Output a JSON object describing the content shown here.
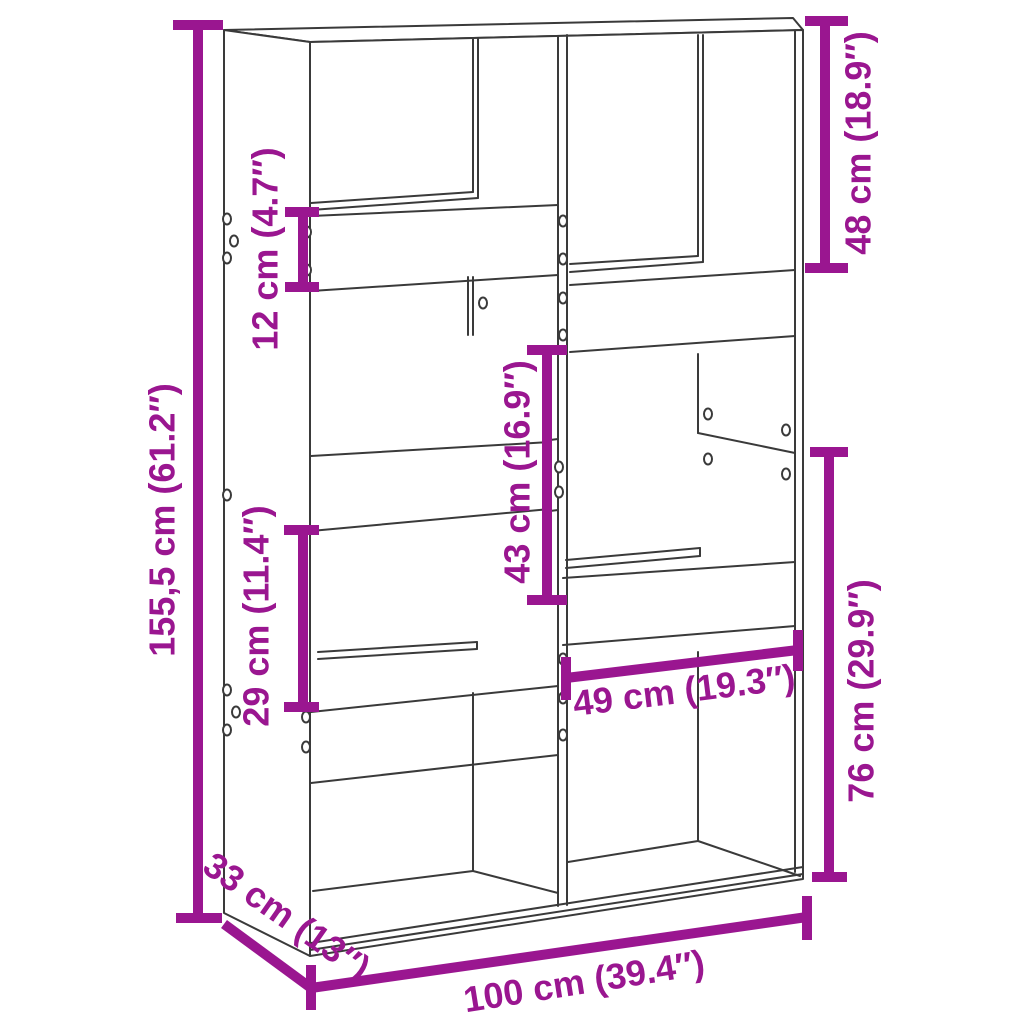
{
  "product_diagram": {
    "kind": "bookcase-room-divider-dimension-drawing",
    "colors": {
      "dimension_accent": "#9A1690",
      "drawing_line": "#3a3a3a",
      "background": "#ffffff"
    },
    "dimensions": {
      "overall_height": "155,5 cm (61.2″)",
      "board_height": "12 cm (4.7″)",
      "top_right_height": "48 cm (18.9″)",
      "middle_height": "43 cm (16.9″)",
      "left_opening_height": "29 cm (11.4″)",
      "opening_width": "49 cm (19.3″)",
      "lower_right_height": "76 cm (29.9″)",
      "depth": "33 cm (13″)",
      "width": "100 cm (39.4″)"
    }
  }
}
